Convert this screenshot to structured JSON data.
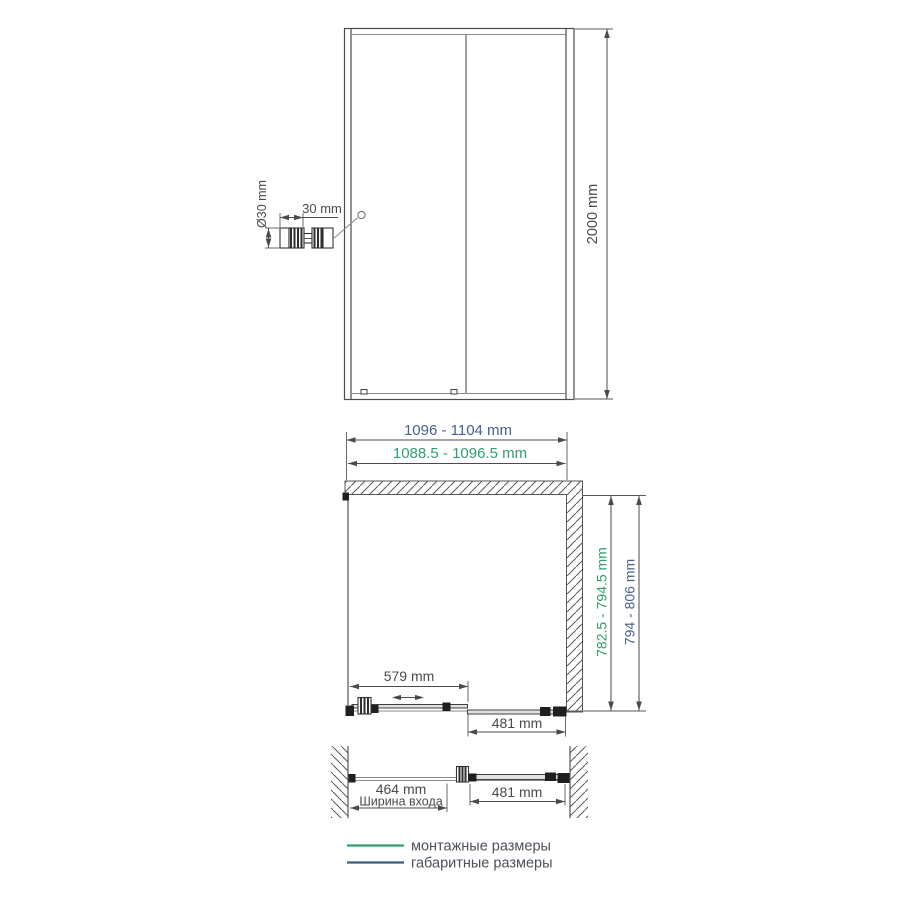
{
  "front_view": {
    "height_dim": "2000 mm",
    "handle": {
      "diameter_dim": "Ø30 mm",
      "cap_width_dim": "30 mm"
    }
  },
  "plan_view": {
    "overall_width_dim": "1096 - 1104 mm",
    "mounting_width_dim": "1088.5 - 1096.5 mm",
    "mounting_depth_dim": "782.5 - 794.5 mm",
    "overall_depth_dim": "794 - 806 mm",
    "sliding_door_dim": "579 mm",
    "fixed_panel_dim": "481 mm"
  },
  "open_view": {
    "entrance_dim": "464 mm",
    "entrance_caption": "Ширина входа",
    "fixed_panel_dim": "481 mm"
  },
  "legend": {
    "mounting": "монтажные размеры",
    "overall": "габаритные размеры"
  },
  "colors": {
    "mounting_green": "#2f9f6a",
    "overall_blue": "#46618c",
    "drawing_line": "#4a4a4a"
  }
}
